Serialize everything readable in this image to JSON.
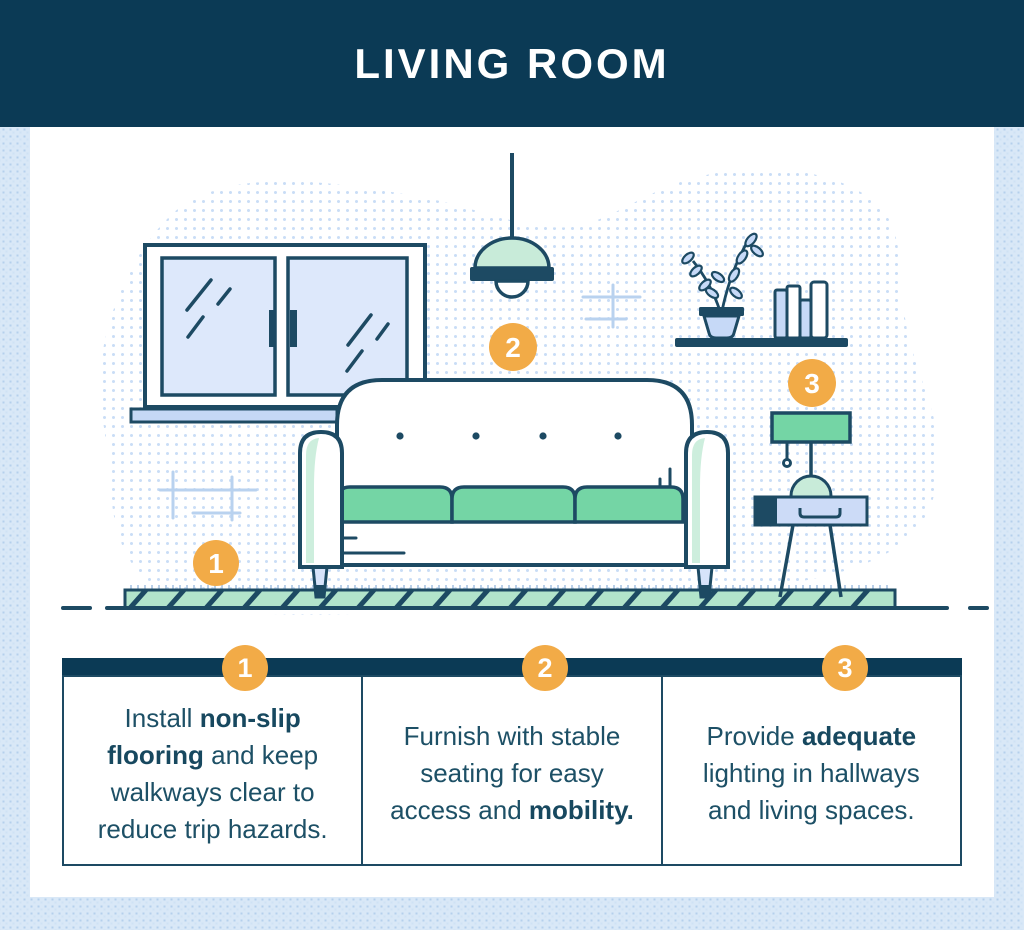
{
  "header": {
    "title": "LIVING ROOM"
  },
  "colors": {
    "header_navy": "#0b3a55",
    "outline_navy": "#1d4a63",
    "text_navy": "#1d5066",
    "badge_orange": "#f2ab47",
    "cushion_green": "#74d5a5",
    "mint": "#cdeedd",
    "rug_mint": "#b2e4cb",
    "glass_blue": "#dde8fb",
    "light_blue_fill": "#c5d8f5",
    "background_blue": "#d9e8f7"
  },
  "illustration": {
    "description": "living-room-scene",
    "markers": [
      {
        "label": "1"
      },
      {
        "label": "2"
      },
      {
        "label": "3"
      }
    ]
  },
  "tips": [
    {
      "number": "1",
      "segments": [
        {
          "text": "Install ",
          "bold": false
        },
        {
          "text": "non-slip flooring",
          "bold": true
        },
        {
          "text": " and keep walkways clear to reduce trip hazards.",
          "bold": false
        }
      ]
    },
    {
      "number": "2",
      "segments": [
        {
          "text": "Furnish with stable seating for easy access and ",
          "bold": false
        },
        {
          "text": "mobility.",
          "bold": true
        }
      ]
    },
    {
      "number": "3",
      "segments": [
        {
          "text": "Provide ",
          "bold": false
        },
        {
          "text": "adequate",
          "bold": true
        },
        {
          "text": " lighting in hallways and living spaces.",
          "bold": false
        }
      ]
    }
  ]
}
